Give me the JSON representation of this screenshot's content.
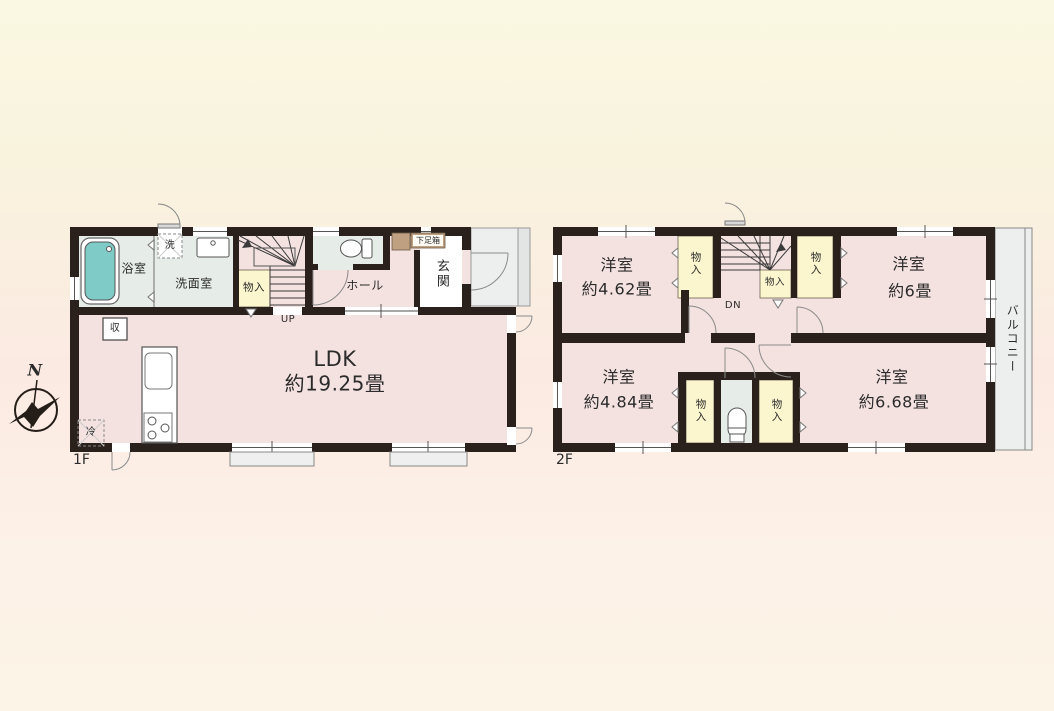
{
  "colors": {
    "background_top": "#faf8e2",
    "background_upper": "#f9f3de",
    "background_mid": "#fbeae2",
    "background_lower": "#fdf2e8",
    "background_bottom": "#fcf4e6",
    "wall": "#2b211c",
    "room_pink": "#f4e2e0",
    "wet_area": "#e6ece8",
    "closet_yellow": "#fbf6ce",
    "shoe_cabinet_tan": "#bfa080",
    "exterior_gray": "#edefef",
    "bathtub_teal": "#7fcbc7",
    "fixture_line": "#777777",
    "stair_line": "#3a3a3a",
    "text": "#2b2b2b"
  },
  "compass": {
    "north_label": "N"
  },
  "floor1": {
    "label": "1F",
    "bathroom_label": "浴室",
    "washer_label": "洗",
    "washroom_label": "洗面室",
    "closet_label": "物入",
    "stairs_label": "UP",
    "hall_label": "ホール",
    "shoe_cabinet_label": "下足箱",
    "entrance_label": "玄関",
    "ldk_name": "LDK",
    "ldk_size": "約19.25畳",
    "storage_label": "収",
    "refrigerator_label": "冷"
  },
  "floor2": {
    "label": "2F",
    "stairs_label": "DN",
    "balcony_label": "バルコニー",
    "rooms": [
      {
        "name": "洋室",
        "size": "約4.62畳"
      },
      {
        "name": "洋室",
        "size": "約6畳"
      },
      {
        "name": "洋室",
        "size": "約4.84畳"
      },
      {
        "name": "洋室",
        "size": "約6.68畳"
      }
    ],
    "closets": [
      {
        "label": "物入"
      },
      {
        "label": "物入"
      },
      {
        "label": "物入"
      },
      {
        "label": "物入"
      },
      {
        "label": "物入"
      }
    ]
  }
}
